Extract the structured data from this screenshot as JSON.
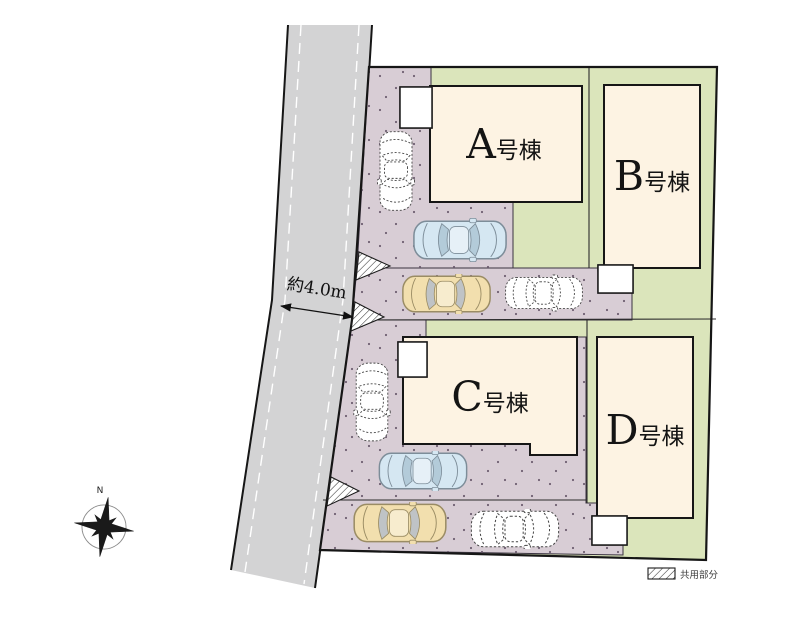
{
  "plan": {
    "title": "site-plan",
    "road_width_label": "約4.0m",
    "compass_label": "N",
    "legend": {
      "label": "共用部分"
    },
    "buildings": [
      {
        "letter": "A",
        "suffix": "号棟"
      },
      {
        "letter": "B",
        "suffix": "号棟"
      },
      {
        "letter": "C",
        "suffix": "号棟"
      },
      {
        "letter": "D",
        "suffix": "号棟"
      }
    ],
    "colors": {
      "lawn": "#dbe5bb",
      "pavement": "#d8cdd5",
      "building": "#fdf3e3",
      "road": "#d3d3d4",
      "car_blue": "#d5e7f2",
      "car_yellow": "#f2dfae"
    }
  }
}
